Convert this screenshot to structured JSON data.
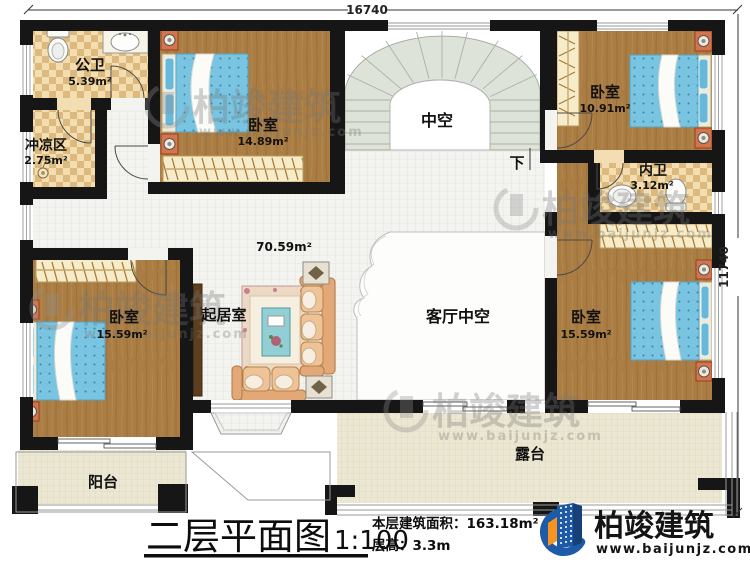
{
  "drawing": {
    "dim_width": "16740",
    "dim_height": "11740",
    "hall_area": "70.59m²",
    "rooms": {
      "public_bath": {
        "name": "公卫",
        "area": "5.39m²"
      },
      "shower_zone": {
        "name": "冲凉区",
        "area": "2.75m²"
      },
      "bedroom_top": {
        "name": "卧室",
        "area": "14.89m²"
      },
      "bedroom_top_right": {
        "name": "卧室",
        "area": "10.91m²"
      },
      "ensuite_bath": {
        "name": "内卫",
        "area": "3.12m²"
      },
      "bedroom_left": {
        "name": "卧室",
        "area": "15.59m²"
      },
      "bedroom_right": {
        "name": "卧室",
        "area": "15.59m²"
      },
      "sitting_room": {
        "name": "起居室"
      },
      "living_void": {
        "name": "客厅中空"
      },
      "stair_void": {
        "name": "中空"
      },
      "stair_down": {
        "name": "下"
      },
      "balcony": {
        "name": "阳台"
      },
      "terrace": {
        "name": "露台"
      }
    }
  },
  "title_block": {
    "title": "二层平面图",
    "scale": "1:100",
    "area_line": "本层建筑面积：163.18m²",
    "floor_height_line": "层高：3.3m"
  },
  "brand": {
    "name": "柏竣建筑",
    "url": "www.baijunjz.com"
  },
  "watermark": {
    "name": "柏竣建筑",
    "url": "www.baijunjz.com"
  },
  "colors": {
    "wall": "#161616",
    "wood_floor": "#aa7d44",
    "tile": "#e9cf9c",
    "bed": "#79c5e1",
    "hall_floor": "#f3f3f0",
    "outdoor_floor": "#ebe7d2",
    "stair": "#dde3d8",
    "sofa": "#eabf92",
    "logo_blue": "#1e5aa8",
    "logo_orange": "#f7941e"
  }
}
